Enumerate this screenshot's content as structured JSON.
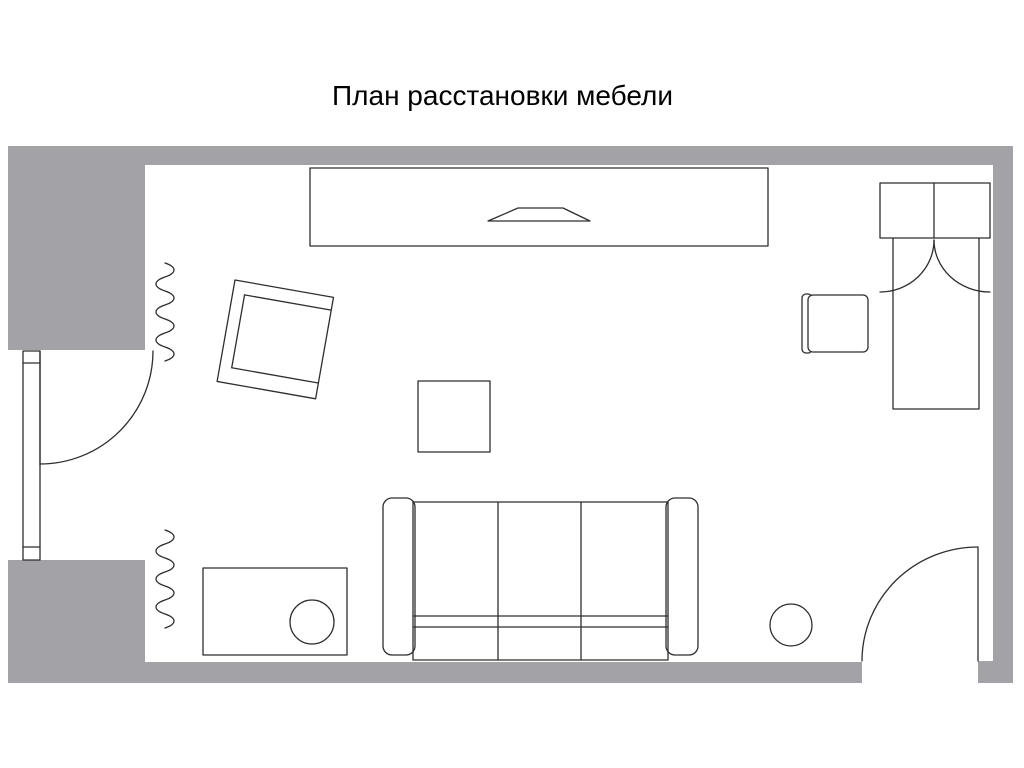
{
  "title": "План расстановки мебели",
  "colors": {
    "wall": "#a2a2a7",
    "line": "#2e2e2e",
    "background": "#ffffff"
  },
  "plan": {
    "type": "furniture-arrangement-floor-plan",
    "furniture": [
      {
        "name": "wall-unit-with-tv",
        "position": "top-center"
      },
      {
        "name": "single-bed",
        "position": "top-right"
      },
      {
        "name": "bedside-chair",
        "position": "right"
      },
      {
        "name": "armchair",
        "position": "upper-left"
      },
      {
        "name": "coffee-table",
        "position": "center"
      },
      {
        "name": "three-seat-sofa",
        "position": "bottom-center"
      },
      {
        "name": "desk",
        "position": "bottom-left"
      },
      {
        "name": "desk-stool",
        "position": "bottom-left"
      },
      {
        "name": "pouf",
        "position": "bottom-right"
      },
      {
        "name": "radiator",
        "position": "upper-left-wall"
      },
      {
        "name": "radiator",
        "position": "lower-left-wall"
      },
      {
        "name": "balcony-door-with-window",
        "position": "left-wall"
      },
      {
        "name": "entrance-door",
        "position": "bottom-right-wall"
      }
    ]
  }
}
